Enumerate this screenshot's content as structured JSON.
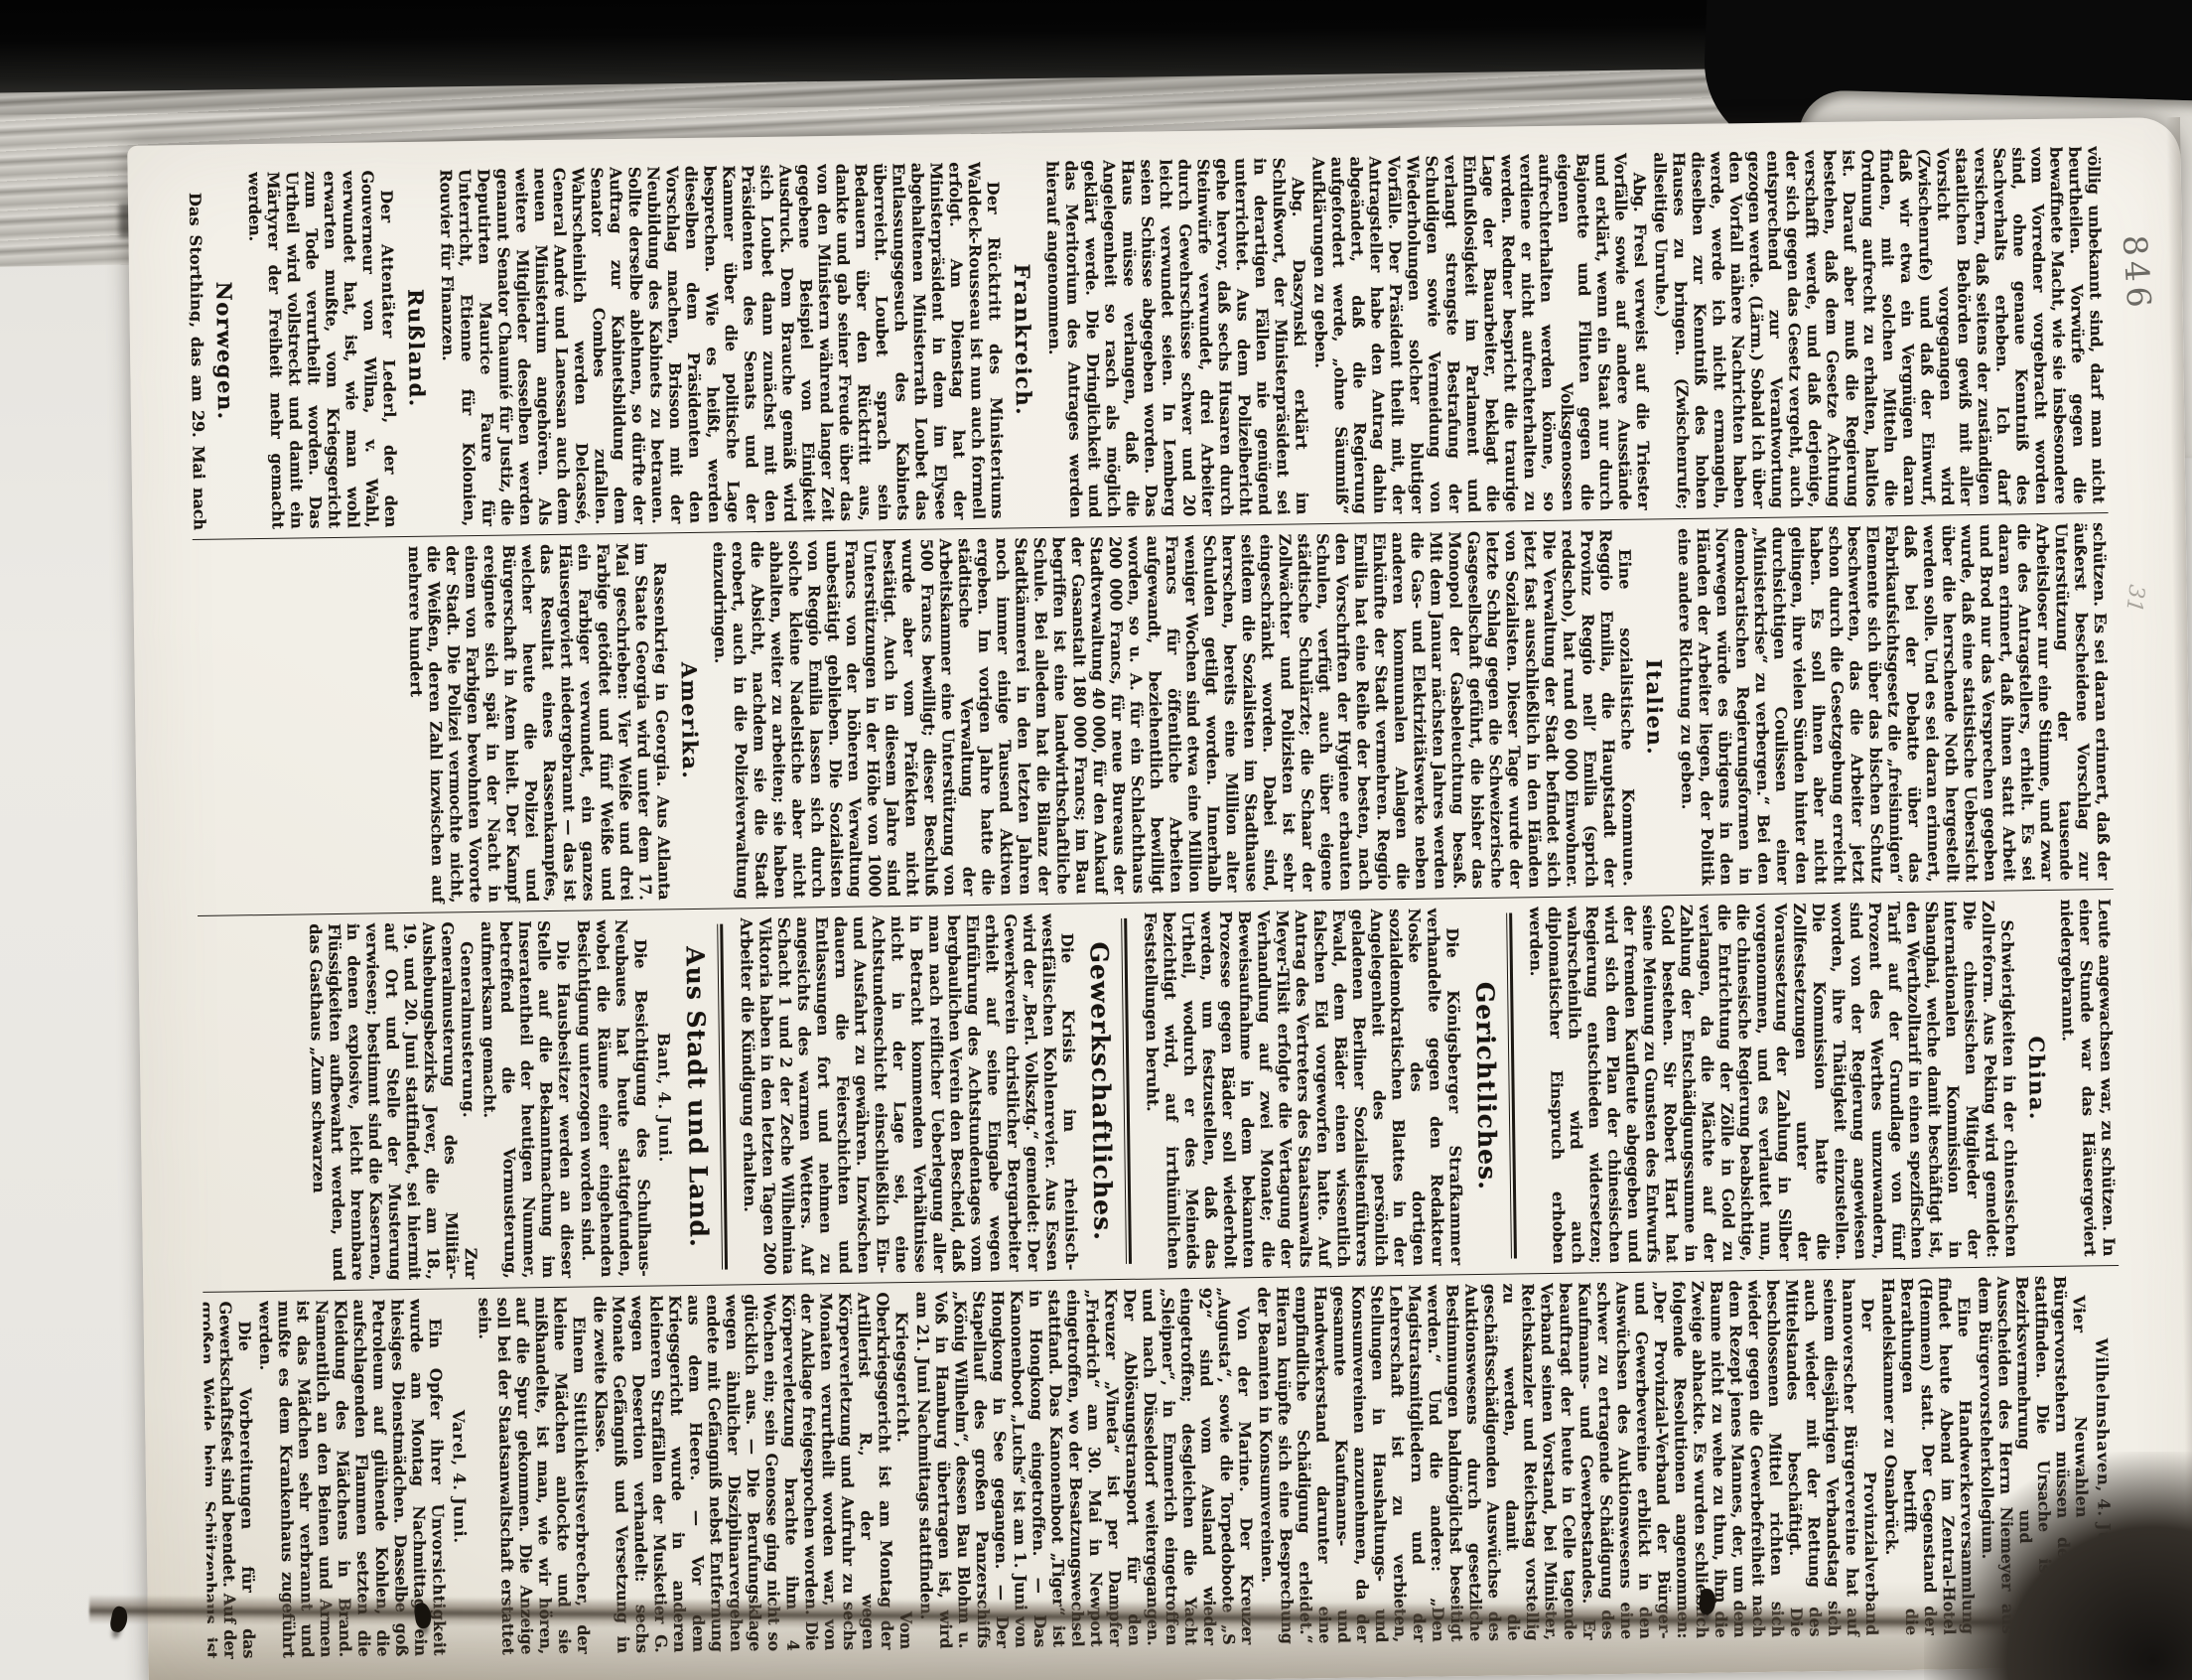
{
  "page": {
    "number": "846",
    "margin_note": "31",
    "columns": [
      {
        "articles": [
          {
            "kind": "para",
            "noindent": true,
            "text": "völlig unbekannt sind, darf man nicht beurtheilen. Vorwürfe gegen die bewaffnete Macht, wie sie insbesondere vom Vorredner vorgebracht worden sind, ohne genaue Kenntniß des Sachverhalts erheben. Ich darf versichern, daß seitens der zuständigen staatlichen Behörden gewiß mit aller Vorsicht vorgegangen wird (Zwischenrufe) und daß der Einwurf, daß wir etwa ein Vergnügen daran finden, mit solchen Mitteln die Ordnung aufrecht zu erhalten, haltlos ist. Darauf aber muß die Regierung bestehen, daß dem Gesetze Achtung verschafft werde, und daß derjenige, der sich gegen das Gesetz vergeht, auch entsprechend zur Verantwortung gezogen werde. (Lärm.) Sobald ich über den Vorfall nähere Nachrichten haben werde, werde ich nicht ermangeln, dieselben zur Kenntniß des hohen Hauses zu bringen. (Zwischenrufe; allseitige Unruhe.)"
          },
          {
            "kind": "para",
            "text": "Abg. Fresl verweist auf die Triester Vorfälle sowie auf andere Ausstände und erklärt, wenn ein Staat nur durch Bajonette und Flinten gegen die eigenen Volksgenossen aufrechterhalten werden könne, so verdiene er nicht aufrechterhalten zu werden. Redner bespricht die traurige Lage der Bauarbeiter, beklagt die Einflußlosigkeit im Parlament und verlangt strengste Bestrafung der Schuldigen sowie Vermeidung von Wiederholungen solcher blutiger Vorfälle. Der Präsident theilt mit, der Antragsteller habe den Antrag dahin abgeändert, daß die Regierung aufgefordert werde, „ohne Säumniß“ Aufklärungen zu geben."
          },
          {
            "kind": "para",
            "text": "Abg. Daszynski erklärt im Schlußwort, der Ministerpräsident sei in derartigen Fällen nie genügend unterrichtet. Aus dem Polizeibericht gehe hervor, daß sechs Husaren durch Steinwürfe verwundet, drei Arbeiter durch Gewehrschüsse schwer und 20 leicht verwundet seien. In Lemberg seien Schüsse abgegeben worden. Das Haus müsse verlangen, daß die Angelegenheit so rasch als möglich geklärt werde. Die Dringlichkeit und das Meritorium des Antrages werden hierauf angenommen."
          },
          {
            "kind": "country",
            "text": "Frankreich."
          },
          {
            "kind": "para",
            "lead": "Der Rücktritt des Ministeriums Waldeck-Rousseau",
            "text": "ist nun auch formell erfolgt. Am Dienstag hat der Ministerpräsident in dem im Elysee abgehaltenen Ministerrath Loubet das Entlassungsgesuch des Kabinets überreicht. Loubet sprach sein Bedauern über den Rücktritt aus, dankte und gab seiner Freude über das von den Ministern während langer Zeit gegebene Beispiel von Einigkeit Ausdruck. Dem Brauche gemäß wird sich Loubet dann zunächst mit den Präsidenten des Senats und der Kammer über die politische Lage besprechen. Wie es heißt, werden dieselben dem Präsidenten den Vorschlag machen, Brisson mit der Neubildung des Kabinets zu betrauen. Sollte derselbe ablehnen, so dürfte der Auftrag zur Kabinetsbildung dem Senator Combes zufallen. Wahrscheinlich werden Delcassé, General André und Lanessan auch dem neuen Ministerium angehören. Als weitere Mitglieder desselben werden genannt Senator Chaumié für Justiz, die Deputirten Maurice Faure für Unterricht, Etienne für Kolonien, Rouvier für Finanzen."
          },
          {
            "kind": "country",
            "text": "Rußland."
          },
          {
            "kind": "para",
            "lead": "Der Attentäter Lederl,",
            "text": "der den Gouverneur von Wilna, v. Wahl, verwundet hat, ist, wie man wohl erwarten mußte, vom Kriegsgericht zum Tode verurtheilt worden. Das Urtheil wird vollstreckt und damit ein Märtyrer der Freiheit mehr gemacht werden."
          },
          {
            "kind": "country",
            "text": "Norwegen."
          },
          {
            "kind": "para",
            "lead": "Das Storthing,",
            "text": "das am 29. Mai nach achtmonatiger Dauer seine Session beendete, hat sich nicht durch eine arbeiterfreundliche Politik ausgezeichnet. „Das, was der Arbeit der Abgeordneten das besondere Gepräge giebt, ist die fortgesetzt erhöhte Verausgabung von staatlichen Mitteln für unproduktive Zwecke und in erster Linie für das Militärwesen“, schreibt „Sozialdemokraten“. „Im Ferneren die ausgeprägteste Knauserigkeit gegenüber den ökonomischen Forderungen, die die Lebensbedingungen der Arbeitermassen erleichtern sollten, sowie der Unwille, diese gegen die Uebergriffe und die Uebermacht der Kapitalisten durch die Gesetzgebung zu"
          }
        ]
      },
      {
        "articles": [
          {
            "kind": "para",
            "noindent": true,
            "text": "schützen. Es sei daran erinnert, daß der äußerst bescheidene Vorschlag zur Unterstützung der tausende Arbeitsloser nur eine Stimme, und zwar die des Antragstellers, erhielt. Es sei daran erinnert, daß ihnen statt Arbeit und Brod nur das Versprechen gegeben wurde, daß eine statistische Uebersicht über die herrschende Noth hergestellt werden solle. Und es sei daran erinnert, daß bei der Debatte über das Fabrikaufsichtsgesetz die „freisinnigen“ Elemente sich über das bischen Schutz beschwerten, das die Arbeiter jetzt schon durch die Gesetzgebung erreicht haben. Es soll ihnen aber nicht gelingen, ihre vielen Sünden hinter den durchsichtigen Coulissen einer „Ministerkrise“ zu verbergen.“ Bei den demokratischen Regierungsformen in Norwegen würde es übrigens in den Händen der Arbeiter liegen, der Politik eine andere Richtung zu geben."
          },
          {
            "kind": "country",
            "text": "Italien."
          },
          {
            "kind": "para",
            "lead": "Eine sozialistische Kommune.",
            "text": "Reggio Emilia, die Hauptstadt der Provinz Reggio nell’ Emilia (sprich reddscho), hat rund 60 000 Einwohner. Die Verwaltung der Stadt befindet sich jetzt fast ausschließlich in den Händen von Sozialisten. Dieser Tage wurde der letzte Schlag gegen die Schweizerische Gasgesellschaft geführt, die bisher das Monopol der Gasbeleuchtung besaß. Mit dem Januar nächsten Jahres werden die Gas- und Elektrizitätswerke neben anderen kommunalen Anlagen die Einkünfte der Stadt vermehren. Reggio Emilia hat eine Reihe der besten, nach den Vorschriften der Hygiene erbauten Schulen, verfügt auch über eigene städtische Schulärzte; die Schaar der Zollwächter und Polizisten ist sehr eingeschränkt worden. Dabei sind, seitdem die Sozialisten im Stadthause herrschen, bereits eine Million alter Schulden getilgt worden. Innerhalb weniger Wochen sind etwa eine Million Francs für öffentliche Arbeiten aufgewandt, beziehentlich bewilligt worden, so u. A. für ein Schlachthaus 200 000 Francs, für neue Bureaus der Stadtverwaltung 40 000, für den Ankauf der Gasanstalt 180 000 Francs; im Bau begriffen ist eine landwirthschaftliche Schule. Bei alledem hat die Bilanz der Stadtkämmerei in den letzten Jahren noch immer einige Tausend Aktiven ergeben. Im vorigen Jahre hatte die städtische Verwaltung der Arbeitskammer eine Unterstützung von 500 Francs bewilligt; dieser Beschluß wurde aber vom Präfekten nicht bestätigt. Auch in diesem Jahre sind Unterstützungen in der Höhe von 1000 Francs von der höheren Verwaltung unbestätigt geblieben. Die Sozialisten von Reggio Emilia lassen sich durch solche kleine Nadelstiche aber nicht abhalten, weiter zu arbeiten; sie haben die Absicht, nachdem sie die Stadt erobert, auch in die Polizeiverwaltung einzudringen."
          },
          {
            "kind": "country",
            "text": "Amerika."
          },
          {
            "kind": "para",
            "lead": "Rassenkrieg in Georgia.",
            "text": "Aus Atlanta im Staate Georgia wird unter dem 17. Mai geschrieben: Vier Weiße und drei Farbige getödtet und fünf Weiße und ein Farbiger verwundet, ein ganzes Häusergeviert niedergebrannt — das ist das Resultat eines Rassenkampfes, welcher heute die Polizei und Bürgerschaft in Atem hielt. Der Kampf ereignete sich spät in der Nacht in einem von Farbigen bewohnten Vororte der Stadt. Die Polizei vermochte nicht, die Weißen, deren Zahl inzwischen auf mehrere hundert"
          }
        ]
      },
      {
        "articles": [
          {
            "kind": "para",
            "noindent": true,
            "text": "Leute angewachsen war, zu schützen. In einer Stunde war das Häusergeviert niedergebrannt."
          },
          {
            "kind": "country",
            "text": "China."
          },
          {
            "kind": "para",
            "lead": "Schwierigkeiten in der chinesischen Zollreform.",
            "text": "Aus Peking wird gemeldet: Die chinesischen Mitglieder der internationalen Kommission in Shanghai, welche damit beschäftigt ist, den Werthzolltarif in einen spezifischen Tarif auf der Grundlage von fünf Prozent des Werthes umzuwandern, sind von der Regierung angewiesen worden, ihre Thätigkeit einzustellen. Die Kommission hatte die Zollfestsetzungen unter der Voraussetzung der Zahlung in Silber vorgenommen, und es verlautet nun, die chinesische Regierung beabsichtige, die Entrichtung der Zölle in Gold zu verlangen, da die Mächte auf der Zahlung der Entschädigungssumme in Gold bestehen. Sir Robert Hart hat seine Meinung zu Gunsten des Entwurfs der fremden Kaufleute abgegeben und wird sich dem Plan der chinesischen Regierung entschieden widersetzen; wahrscheinlich wird auch diplomatischer Einspruch erhoben werden."
          },
          {
            "kind": "section",
            "text": "Gerichtliches."
          },
          {
            "kind": "para",
            "lead": "Die Königsberger Strafkammer",
            "text": "verhandelte gegen den Redakteur Noske des dortigen sozialdemokratischen Blattes in der Angelegenheit des persönlich geladenen Berliner Sozialistenführers Ewald, dem Bäder einen wissentlich falschen Eid vorgeworfen hatte. Auf Antrag des Vertreters des Staatsanwalts Meyer-Tilsit erfolgte die Vertagung der Verhandlung auf zwei Monate; die Beweisaufnahme in dem bekannten Prozesse gegen Bäder soll wiederholt werden, um festzustellen, daß das Urtheil, wodurch er des Meineids bezichtigt wird, auf irrthümlichen Feststellungen beruht."
          },
          {
            "kind": "section",
            "text": "Gewerkschaftliches."
          },
          {
            "kind": "para",
            "lead": "Die Krisis im rheinisch-westfälischen Kohlenrevier.",
            "text": "Aus Essen wird der „Berl. Volksztg.“ gemeldet: Der Gewerkverein christlicher Bergarbeiter erhielt auf seine Eingabe wegen Einführung des Achtstundentages vom bergbaulichen Verein den Bescheid, daß man nach reiflicher Ueberlegung aller in Betracht kommenden Verhältnisse nicht in der Lage sei, eine Achtstundenschicht einschließlich Ein- und Ausfahrt zu gewähren. Inzwischen dauern die Feierschichten und Entlassungen fort und nehmen zu angesichts des warmen Wetters. Auf Schacht 1 und 2 der Zeche Wilhelmina Viktoria haben in den letzten Tagen 200 Arbeiter die Kündigung erhalten."
          },
          {
            "kind": "section",
            "text": "Aus Stadt und Land."
          },
          {
            "kind": "dateline",
            "text": "Bant, 4. Juni."
          },
          {
            "kind": "para",
            "text": "Die Besichtigung des Schulhaus-Neubaues hat heute stattgefunden, wobei die Räume einer eingehenden Besichtigung unterzogen worden sind."
          },
          {
            "kind": "para",
            "lead": "Die Hausbesitzer",
            "text": "werden an dieser Stelle auf die Bekanntmachung im Inseratentheil der heutigen Nummer, betreffend die Vormusterung, aufmerksam gemacht."
          },
          {
            "kind": "para",
            "lead": "Generalmusterung.",
            "text": "Zur Generalmusterung des Militär-Aushebungsbezirks Jever, die am 18., 19. und 20. Juni stattfindet, sei hiermit auf Ort und Stelle der Musterung verwiesen; bestimmt sind die Kasernen, in denen explosive, leicht brennbare Flüssigkeiten aufbewahrt werden, und das Gasthaus „Zum schwarzen"
          }
        ]
      },
      {
        "articles": [
          {
            "kind": "dateline",
            "text": "Wilhelmshaven, 4. Juni."
          },
          {
            "kind": "para",
            "lead": "Vier Neuwahlen",
            "text": "von Bürgervorstehern müssen demnächst stattfinden. Die Ursache ist die Bezirksvermehrung und das Ausscheiden des Herrn Niemeyer aus dem Bürgervorsteherkollegium."
          },
          {
            "kind": "para",
            "lead": "Eine Handwerkerversammlung",
            "text": "findet heute Abend im Zentral-Hotel (Hemmen) statt. Der Gegenstand der Berathungen betrifft die Handelskammer zu Osnabrück."
          },
          {
            "kind": "para",
            "lead": "Der Provinzialverband hannoverscher Bürgervereine",
            "text": "hat auf seinem diesjährigen Verbandstag sich auch wieder mit der Rettung des Mittelstandes beschäftigt. Die beschlossenen Mittel richten sich wieder gegen die Gewerbefreiheit nach dem Rezept jenes Mannes, der, um dem Baume nicht zu wehe zu thun, ihm die Zweige abhackte. Es wurden schließlich folgende Resolutionen angenommen: „Der Provinzial-Verband der Bürger- und Gewerbevereine erblickt in den Auswüchsen des Auktionswesens eine schwer zu ertragende Schädigung des Kaufmanns- und Gewerbestandes. Er beauftragt der heute in Celle tagende Verband seinen Vorstand, bei Minister, Reichskanzler und Reichstag vorstellig zu werden, damit die geschäftsschädigenden Auswüchse des Auktionswesens durch gesetzliche Bestimmungen baldmöglichst beseitigt werden.“ Und die andere: „Den Magistratsmitgliedern und der Lehrerschaft ist zu verbieten, Stellungen in Haushaltungs- und Konsumvereinen anzunehmen, da der gesammte Kaufmanns- und Handwerkerstand darunter eine empfindliche Schädigung erleidet.“ Hieran knüpfte sich eine Besprechung der Beamten in Konsumvereinen."
          },
          {
            "kind": "para",
            "lead": "Von der Marine.",
            "text": "Der Kreuzer „Augusta“, sowie die Torpedoboote „S 92“ sind vom Ausland wieder eingetroffen; desgleichen die Yacht „Sleipner“, in Emmerich eingetroffen und nach Düsseldorf weitergegangen. Der Ablösungstransport für den Kreuzer „Vineta“ ist per Dampfer „Friedrich“ am 30. Mai in Newport eingetroffen, wo der Besatzungswechsel stattfand. Das Kanonenboot „Tiger“ ist in Hongkong eingetroffen. — Das Kanonenboot „Luchs“ ist am 1. Juni von Hongkong in See gegangen. — Der Stapellauf des großen Panzerschiffs „König Wilhelm“, dessen Bau Blohm u. Voß in Hamburg übertragen ist, wird am 21. Juni Nachmittags stattfinden."
          },
          {
            "kind": "para",
            "lead": "Kriegsgericht.",
            "text": "Vom Oberkriegsgericht ist am Montag der Artillerist R., der wegen Körperverletzung und Aufruhr zu sechs Monaten verurtheilt worden war, von der Anklage freigesprochen worden. Die Körperverletzung brachte ihm 4 Wochen ein; sein Genosse ging nicht so glücklich aus. — Die Berufungsklage wegen ähnlicher Disziplinarvergehen endete mit Gefängniß nebst Entfernung aus dem Heere. — Vor dem Kriegsgericht wurde in anderen kleineren Straffällen der Musketier G. wegen Desertion verhandelt: sechs Monate Gefängniß und Versetzung in die zweite Klasse."
          },
          {
            "kind": "para",
            "lead": "Einem Sittlichkeitsverbrecher,",
            "text": "der kleine Mädchen anlockte und sie mißhandelte, ist man, wie wir hören, auf die Spur gekommen. Die Anzeige soll bei der Staatsanwaltschaft erstattet sein."
          },
          {
            "kind": "dateline",
            "text": "Varel, 4. Juni."
          },
          {
            "kind": "para",
            "lead": "Ein Opfer ihrer Unvorsichtigkeit",
            "text": "wurde am Montag Nachmittag ein hiesiges Dienstmädchen. Dasselbe goß Petroleum auf glühende Kohlen, die aufschlagenden Flammen setzten die Kleidung des Mädchens in Brand. Namentlich an den Beinen und Armen ist das Mädchen sehr verbrannt und mußte es dem Krankenhaus zugeführt werden."
          },
          {
            "kind": "para",
            "lead": "Die Vorbereitungen",
            "text": "für das Gewerkschaftsfest sind beendet. Auf der großen Weide beim Schützenhaus ist man beschäftigt, eine Budenstadt aufzubauen. Hoffentlich ist das Wetter dem Feste günstig."
          },
          {
            "kind": "dateline",
            "text": "Zetel, 4. Juni."
          },
          {
            "kind": "para",
            "lead": "Feuer",
            "text": "brach am Montag Nachmittag in der Regnen’schen Weberei aus. Dasselbe soll durch Explosion einer Lampe entstanden sein. Der Schaden ist ein beträchtlicher, doch wird der Betrieb nicht gestört."
          },
          {
            "kind": "dateline",
            "text": "Oldenburg, 4. Juni."
          },
          {
            "kind": "para",
            "lead": "Der Verein gegen Bettelei",
            "text": "hat im Gildesaale des Landesgewerbemuseums eine Generalversammlung abgehalten. Der 22. Jahresbericht ergiebt, daß die Zahl der Arbeitslosen, die den Verein in Anspruch genommen haben, 3561 beträgt, das sind 956 mehr als im Vorjahr, mit einem höheren Kostenaufwand von 478 M."
          }
        ]
      }
    ]
  },
  "colors": {
    "paper": "#f4f1ea",
    "ink": "#1b1611",
    "book_edge": "#0a0a0a",
    "scan_background": "#e7e5e0"
  }
}
